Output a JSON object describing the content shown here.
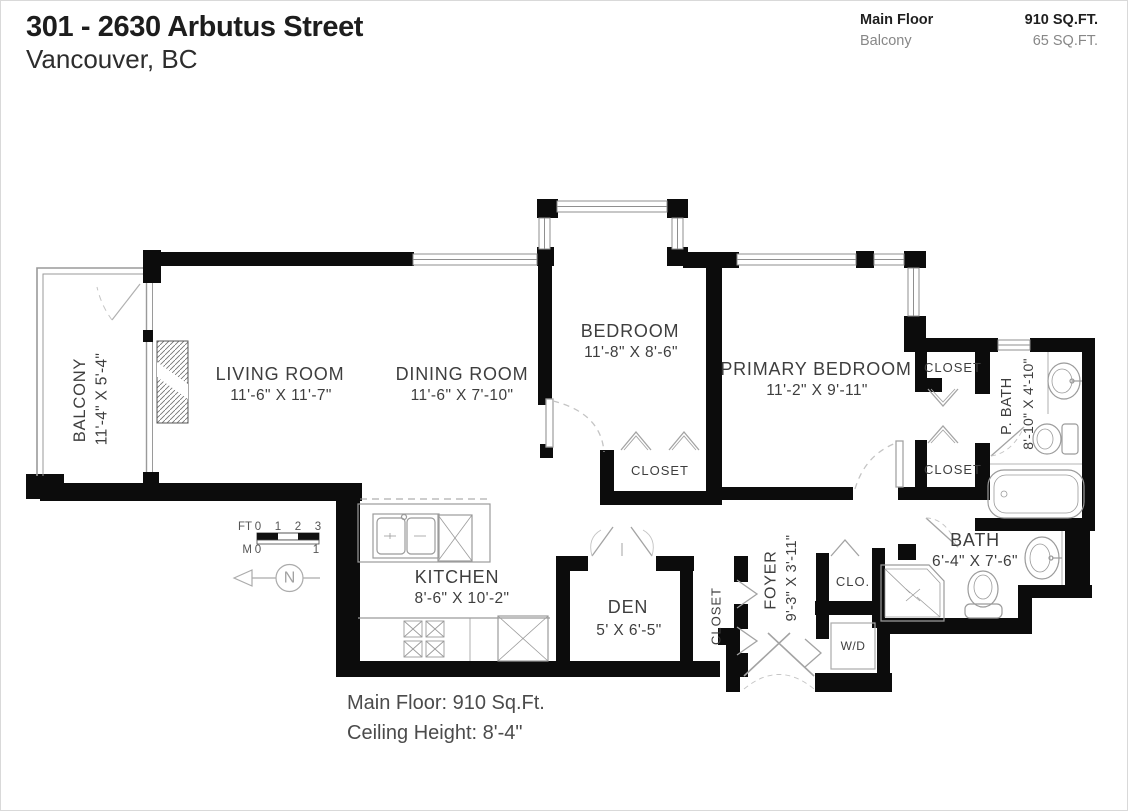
{
  "header": {
    "title": "301 - 2630 Arbutus Street",
    "subtitle": "Vancouver, BC"
  },
  "area_summary": {
    "rows": [
      {
        "label": "Main Floor",
        "value": "910 SQ.FT."
      },
      {
        "label": "Balcony",
        "value": "65 SQ.FT."
      }
    ]
  },
  "labels": {
    "balcony_name": "BALCONY",
    "balcony_dims": "11'-4\" X 5'-4\"",
    "living_name": "LIVING ROOM",
    "living_dims": "11'-6\" X 11'-7\"",
    "dining_name": "DINING ROOM",
    "dining_dims": "11'-6\" X 7'-10\"",
    "bedroom_name": "BEDROOM",
    "bedroom_dims": "11'-8\" X 8'-6\"",
    "primary_name": "PRIMARY BEDROOM",
    "primary_dims": "11'-2\" X 9'-11\"",
    "pbath_name": "P. BATH",
    "pbath_dims": "8'-10\" X 4'-10\"",
    "bath_name": "BATH",
    "bath_dims": "6'-4\" X 7'-6\"",
    "kitchen_name": "KITCHEN",
    "kitchen_dims": "8'-6\" X 10'-2\"",
    "den_name": "DEN",
    "den_dims": "5' X 6'-5\"",
    "foyer_name": "FOYER",
    "foyer_dims": "9'-3\" X 3'-11\"",
    "closet_bedroom": "CLOSET",
    "closet_primary_upper": "CLOSET",
    "closet_primary_lower": "CLOSET",
    "closet_den": "CLOSET",
    "clo": "CLO.",
    "wd": "W/D"
  },
  "scale_bar": {
    "ft_label": "FT",
    "ft_ticks": [
      "0",
      "1",
      "2",
      "3"
    ],
    "m_label": "M",
    "m_ticks": [
      "0",
      "1"
    ]
  },
  "compass": {
    "north": "N"
  },
  "footer": {
    "line1": "Main Floor: 910 Sq.Ft.",
    "line2": "Ceiling Height: 8'-4\""
  },
  "colors": {
    "wall": "#0c0c0c",
    "fixture": "#9b9b9b",
    "label": "#3e3e3e"
  }
}
